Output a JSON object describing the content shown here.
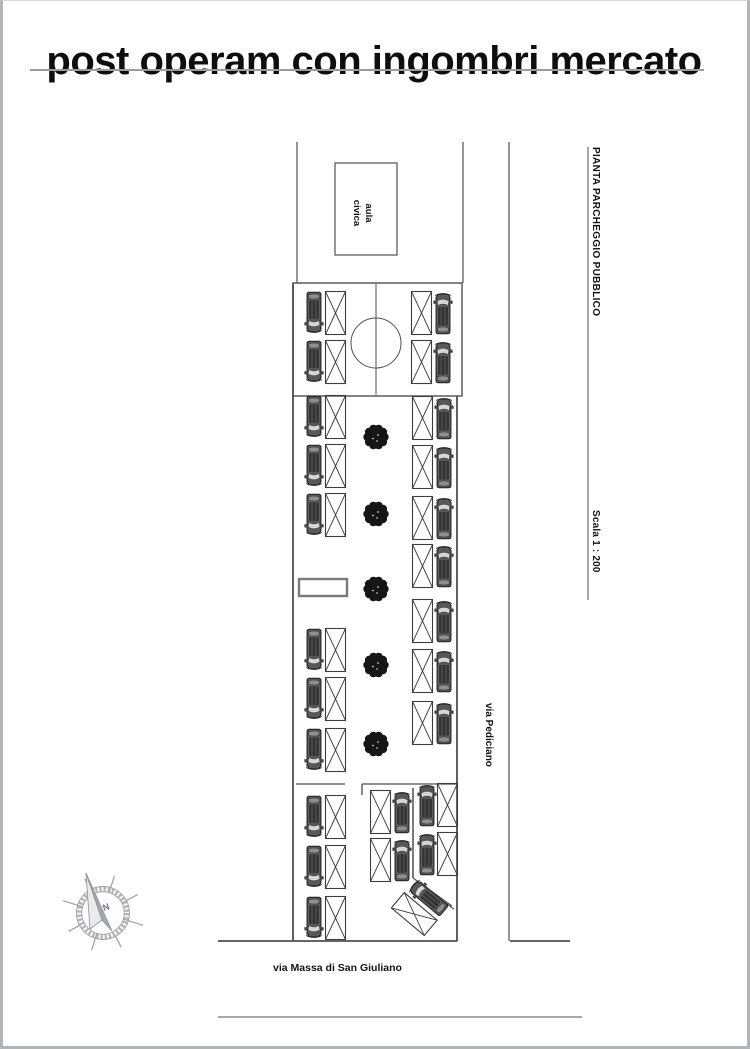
{
  "page": {
    "title": "post operam con ingombri mercato",
    "width": 750,
    "height": 1049
  },
  "labels": {
    "building": "aula civica",
    "drawing_title": "PIANTA PARCHEGGIO PUBBLICO",
    "scale": "Scala 1 : 200",
    "street_vertical": "via Pediciano",
    "street_horizontal": "via Massa di San Giuliano",
    "compass_north": "N"
  },
  "colors": {
    "line": "#4f4f4f",
    "line_soft": "#8a8a8a",
    "page_border": "#b2b5b7",
    "title_rule": "#9c9c9c",
    "car_body": "#585858",
    "car_roof": "#343434",
    "tree": "#161616",
    "text": "#141414"
  },
  "plan": {
    "lines": [
      {
        "x1": 297,
        "y1": 142,
        "x2": 297,
        "y2": 283,
        "w": 1.2
      },
      {
        "x1": 463,
        "y1": 142,
        "x2": 463,
        "y2": 283,
        "w": 1.2
      },
      {
        "x1": 509,
        "y1": 142,
        "x2": 509,
        "y2": 941,
        "w": 1.2
      },
      {
        "x1": 588,
        "y1": 147,
        "x2": 588,
        "y2": 600,
        "w": 1
      },
      {
        "x1": 376,
        "y1": 284,
        "x2": 376,
        "y2": 395,
        "w": 1
      },
      {
        "x1": 293,
        "y1": 283,
        "x2": 293,
        "y2": 941,
        "w": 1.8
      },
      {
        "x1": 457,
        "y1": 396,
        "x2": 457,
        "y2": 941,
        "w": 1.8
      },
      {
        "x1": 296,
        "y1": 784,
        "x2": 345,
        "y2": 784,
        "w": 1.3
      },
      {
        "x1": 362,
        "y1": 784,
        "x2": 457,
        "y2": 784,
        "w": 1.3
      },
      {
        "x1": 362,
        "y1": 784,
        "x2": 362,
        "y2": 795,
        "w": 1.3
      },
      {
        "x1": 413,
        "y1": 788,
        "x2": 413,
        "y2": 878,
        "w": 1.5
      },
      {
        "x1": 413,
        "y1": 878,
        "x2": 452,
        "y2": 906,
        "w": 1.1
      },
      {
        "x1": 416,
        "y1": 882,
        "x2": 454,
        "y2": 909,
        "w": 1.1
      },
      {
        "x1": 218,
        "y1": 941,
        "x2": 457,
        "y2": 941,
        "w": 1.8
      },
      {
        "x1": 510,
        "y1": 941,
        "x2": 570,
        "y2": 941,
        "w": 1.8
      },
      {
        "x1": 218,
        "y1": 1017,
        "x2": 582,
        "y2": 1017,
        "w": 1.6,
        "c": "#8a8a8a"
      }
    ],
    "rects": [
      {
        "x": 293,
        "y": 283,
        "w": 169,
        "h": 113,
        "sw": 1.4,
        "n": "parking-court-outline"
      },
      {
        "x": 335,
        "y": 163,
        "w": 62,
        "h": 92,
        "sw": 1.2,
        "n": "building-outline"
      },
      {
        "x": 299,
        "y": 579,
        "w": 48,
        "h": 17,
        "sw": 2.4,
        "c": "#7a7a7a",
        "f": "#ffffff",
        "n": "ramp-outline"
      }
    ],
    "circle": {
      "cx": 376,
      "cy": 343,
      "r": 25
    },
    "units": [
      {
        "t": "L",
        "x": 305,
        "y": 291
      },
      {
        "t": "R",
        "x": 411,
        "y": 291
      },
      {
        "t": "L",
        "x": 305,
        "y": 340
      },
      {
        "t": "R",
        "x": 411,
        "y": 340
      },
      {
        "t": "L",
        "x": 305,
        "y": 395
      },
      {
        "t": "L",
        "x": 305,
        "y": 444
      },
      {
        "t": "L",
        "x": 305,
        "y": 493
      },
      {
        "t": "L",
        "x": 305,
        "y": 628
      },
      {
        "t": "L",
        "x": 305,
        "y": 677
      },
      {
        "t": "L",
        "x": 305,
        "y": 728
      },
      {
        "t": "R",
        "x": 412,
        "y": 396
      },
      {
        "t": "R",
        "x": 412,
        "y": 445
      },
      {
        "t": "R",
        "x": 412,
        "y": 496
      },
      {
        "t": "R",
        "x": 412,
        "y": 544
      },
      {
        "t": "R",
        "x": 412,
        "y": 599
      },
      {
        "t": "R",
        "x": 412,
        "y": 649
      },
      {
        "t": "R",
        "x": 412,
        "y": 701
      },
      {
        "t": "L",
        "x": 305,
        "y": 795
      },
      {
        "t": "L",
        "x": 305,
        "y": 845
      },
      {
        "t": "L",
        "x": 305,
        "y": 896
      },
      {
        "t": "R",
        "x": 370,
        "y": 790
      },
      {
        "t": "R",
        "x": 370,
        "y": 838
      },
      {
        "t": "B",
        "x": 418,
        "y": 783
      },
      {
        "t": "B",
        "x": 418,
        "y": 832
      },
      {
        "t": "R",
        "x": 400,
        "y": 884,
        "rot": -50,
        "cx": 421,
        "cy": 906
      }
    ],
    "trees": [
      {
        "x": 376,
        "y": 437
      },
      {
        "x": 376,
        "y": 514
      },
      {
        "x": 376,
        "y": 589
      },
      {
        "x": 376,
        "y": 665
      },
      {
        "x": 376,
        "y": 744
      }
    ]
  }
}
